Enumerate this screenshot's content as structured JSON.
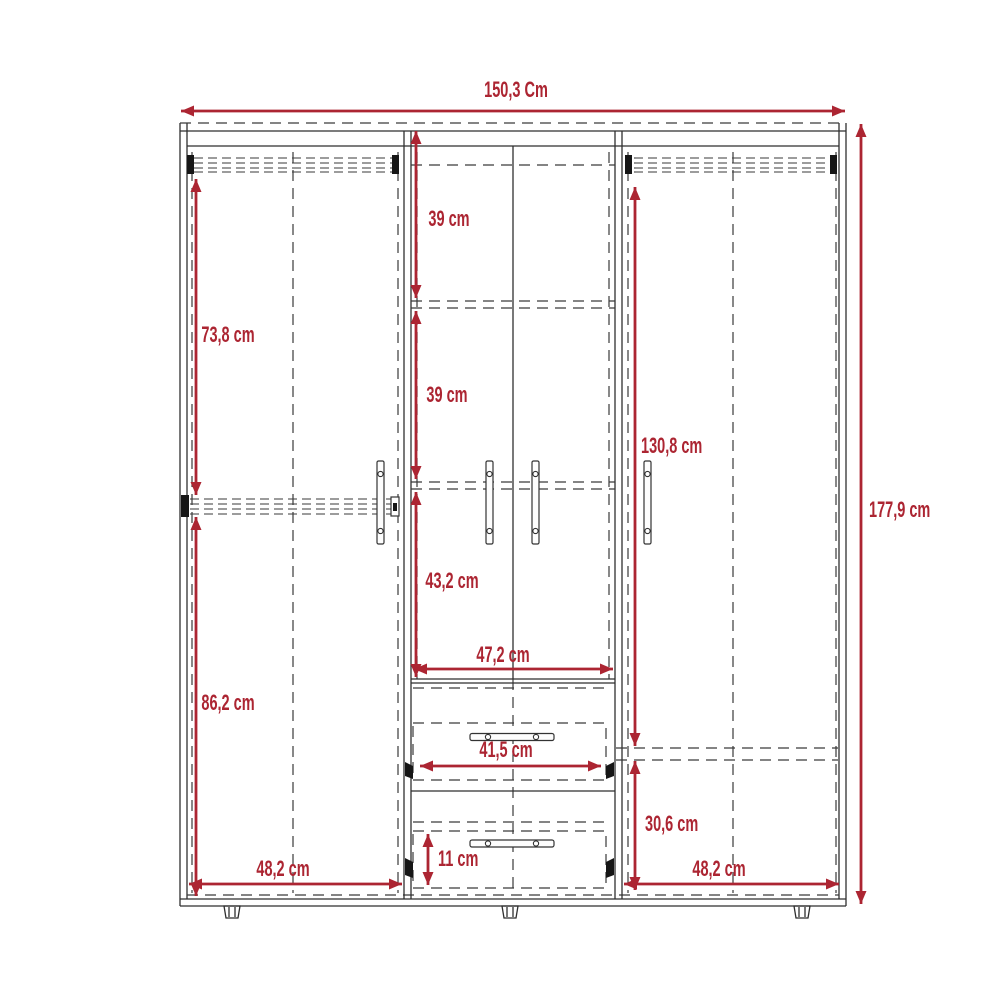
{
  "diagram": {
    "unit_note": "wardrobe dimensional drawing",
    "colors": {
      "accent_red": "#ac2532",
      "line_dark": "#2f2f2f",
      "background": "#ffffff"
    }
  },
  "dimensions": {
    "overall_width": "150,3 Cm",
    "overall_height": "177,9 cm",
    "left_section": {
      "upper_height": "73,8 cm",
      "lower_height": "86,2 cm",
      "width": "48,2 cm"
    },
    "center_section": {
      "top_shelf_height": "39 cm",
      "middle_shelf_height": "39 cm",
      "lower_compartment_height": "43,2 cm",
      "inner_width": "47,2 cm",
      "drawer_width": "41,5 cm",
      "drawer_height": "11 cm"
    },
    "right_section": {
      "upper_height": "130,8 cm",
      "lower_height": "30,6 cm",
      "width": "48,2 cm"
    }
  }
}
